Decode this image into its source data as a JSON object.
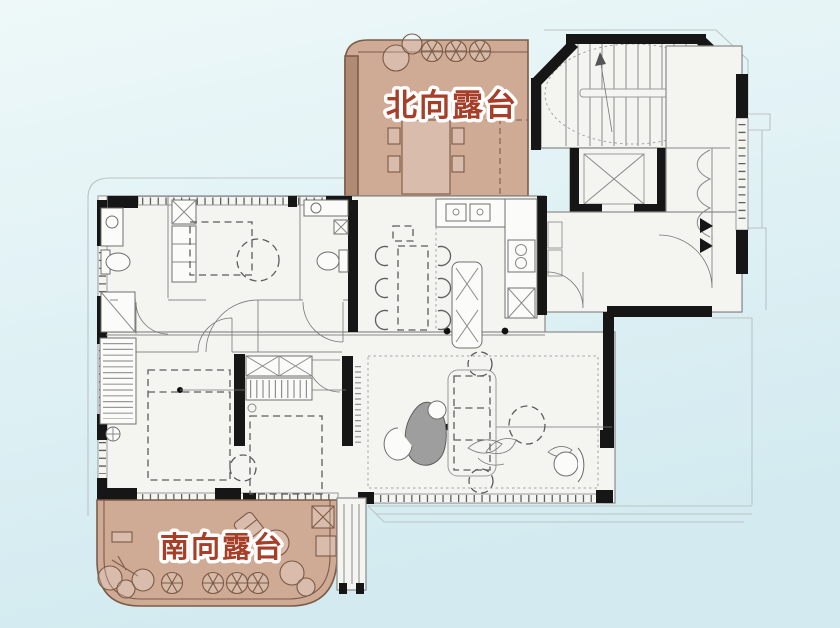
{
  "plan": {
    "north_terrace_label": "北向露台",
    "south_terrace_label": "南向露台"
  },
  "palette": {
    "background_top": "#eef8f9",
    "background_bottom": "#d2eaf0",
    "floor": "#f4f4f1",
    "walls": "#161616",
    "outlines": "#8a8a8a",
    "terrace_fill": "#cfaa95",
    "terrace_dark": "#b08a72",
    "terrace_outline": "#7d5c48",
    "label_fill": "#a63e28",
    "label_halo": "#ffffff",
    "rug": "#9e9e9e"
  }
}
